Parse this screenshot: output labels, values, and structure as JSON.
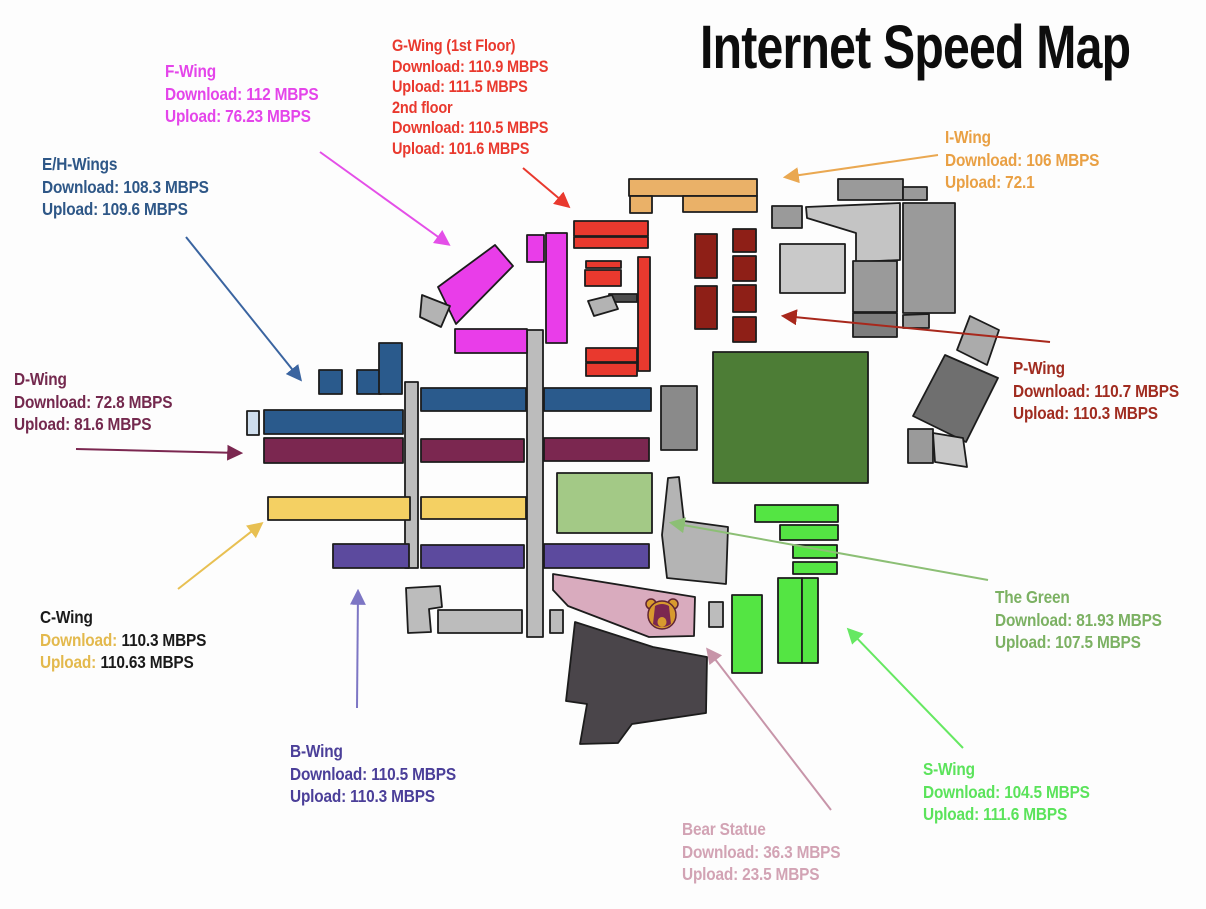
{
  "title": "Internet Speed Map",
  "annotations": {
    "f_wing": {
      "title": "F-Wing",
      "download": "Download: 112 MBPS",
      "upload": "Upload: 76.23 MBPS"
    },
    "g_wing": {
      "title": "G-Wing (1st Floor)",
      "download": "Download: 110.9 MBPS",
      "upload": "Upload: 111.5 MBPS",
      "floor2_title": "2nd floor",
      "floor2_download": "Download: 110.5 MBPS",
      "floor2_upload": "Upload: 101.6 MBPS"
    },
    "eh_wings": {
      "title": "E/H-Wings",
      "download": "Download: 108.3 MBPS",
      "upload": "Upload: 109.6 MBPS"
    },
    "i_wing": {
      "title": "I-Wing",
      "download": "Download: 106 MBPS",
      "upload": "Upload: 72.1"
    },
    "d_wing": {
      "title": "D-Wing",
      "download": "Download: 72.8 MBPS",
      "upload": "Upload: 81.6 MBPS"
    },
    "p_wing": {
      "title": "P-Wing",
      "download": "Download: 110.7 MBPS",
      "upload": "Upload: 110.3 MBPS"
    },
    "c_wing": {
      "title": "C-Wing",
      "download_label": "Download:",
      "download_value": "110.3 MBPS",
      "upload_label": "Upload:",
      "upload_value": "110.63 MBPS"
    },
    "b_wing": {
      "title": "B-Wing",
      "download": "Download: 110.5 MBPS",
      "upload": "Upload: 110.3 MBPS"
    },
    "the_green": {
      "title": "The Green",
      "download": "Download: 81.93 MBPS",
      "upload": "Upload: 107.5 MBPS"
    },
    "s_wing": {
      "title": "S-Wing",
      "download": "Download: 104.5 MBPS",
      "upload": "Upload: 111.6 MBPS"
    },
    "bear_statue": {
      "title": "Bear Statue",
      "download": "Download: 36.3 MBPS",
      "upload": "Upload: 23.5 MBPS"
    }
  },
  "colors": {
    "f_wing": "#e445ea",
    "g_wing": "#e9392e",
    "eh_wings": "#2e5787",
    "i_wing": "#e9a044",
    "d_wing": "#74294e",
    "p_wing": "#a02c20",
    "c_wing_text": "#1a1a1a",
    "c_wing_accent": "#e3b94d",
    "b_wing": "#4b3f99",
    "the_green": "#7cb163",
    "s_wing": "#5be35b",
    "bear_statue": "#d2a3b4",
    "title": "#0d0d0d"
  }
}
